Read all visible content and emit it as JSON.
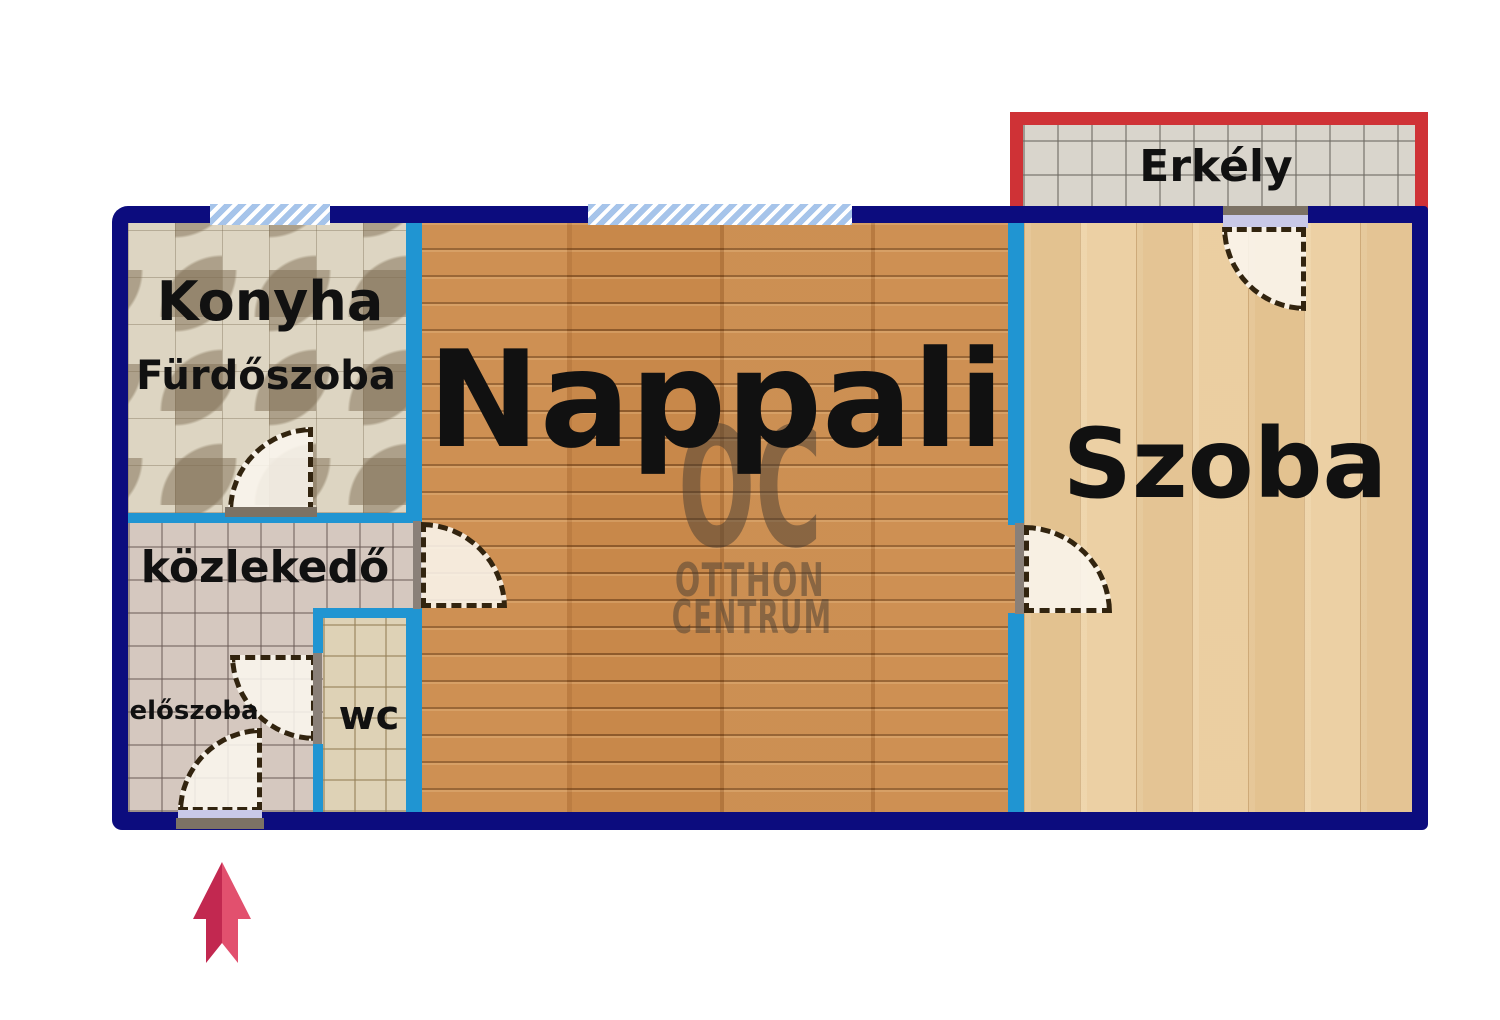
{
  "rooms": {
    "konyha": {
      "label": "Konyha"
    },
    "furdoszoba": {
      "label": "Fürdőszoba"
    },
    "nappali": {
      "label": "Nappali"
    },
    "szoba": {
      "label": "Szoba"
    },
    "erkely": {
      "label": "Erkély"
    },
    "kozlekedo": {
      "label": "közlekedő"
    },
    "eloszoba": {
      "label": "előszoba"
    },
    "wc": {
      "label": "wc"
    }
  },
  "watermark": {
    "logo": "OC",
    "line1": "OTTHON",
    "line2": "CENTRUM"
  },
  "colors": {
    "outer_wall": "#0c0c7e",
    "inner_wall": "#2095d2",
    "balcony_frame": "#cf3236",
    "window_fill": "#a6c4ea",
    "door_dash": "#32240f",
    "door_fill": "#f7f3ea",
    "jamb_gray": "#8a8078",
    "threshold_gray": "#7c7265",
    "door_leaf_lavender": "#c9c9e8",
    "arrow_dark": "#c22850",
    "arrow_light": "#e2506e",
    "label_color": "#111111"
  }
}
